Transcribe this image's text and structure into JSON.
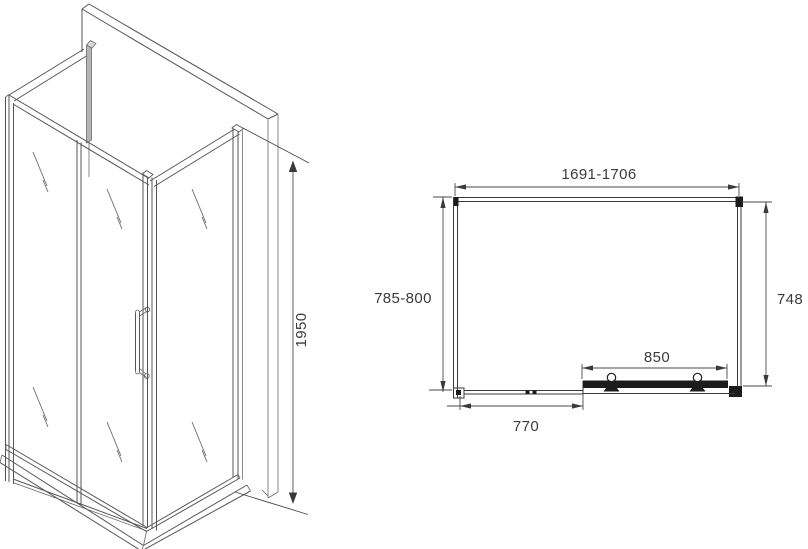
{
  "page": {
    "background_color": "#ffffff",
    "line_color": "#4a4a4a",
    "dark_fill_color": "#1c1c1c"
  },
  "isometric_view": {
    "description": "shower-enclosure-isometric-drawing",
    "height_label": "1950"
  },
  "plan_view": {
    "description": "shower-enclosure-top-plan-drawing",
    "width_label": "1691-1706",
    "left_depth_label": "785-800",
    "right_depth_label": "748",
    "door_width_label": "850",
    "side_panel_label": "770"
  }
}
